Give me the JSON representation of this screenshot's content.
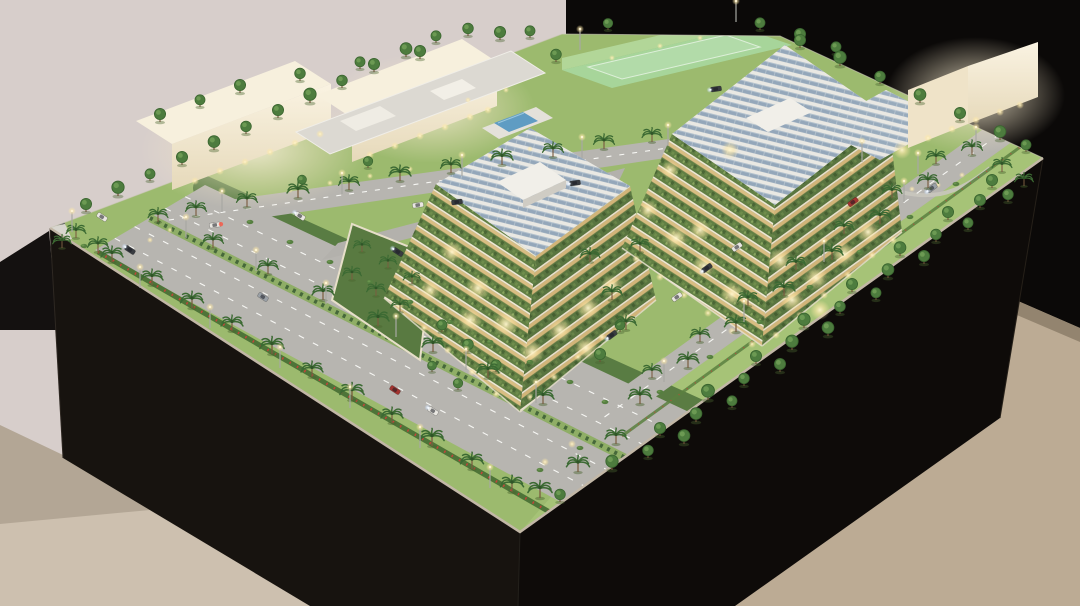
{
  "colors": {
    "wall": "#d7cecb",
    "backdrop": "#0b0908",
    "floor_left": "#cdc0af",
    "floor_right": "#bcab94",
    "skirting": "#93846f",
    "shadow_wedge": "#141110",
    "plinth_left": "#17130f",
    "plinth_right": "#0e0b09",
    "grass": "#9cba6e",
    "lawn": "#a6c377",
    "garden": "#54763f",
    "road": "#b7b5b0",
    "road_line": "#f7f7f4",
    "median": "#8fae66",
    "hedge": "#4e7438",
    "hedge_flowers": "#c2453a",
    "fascia": "#c2b7a6",
    "back_wall_line": "#cdc8ba",
    "white_roof": "#f7f0dd",
    "white_face_top": "#faf3e2",
    "white_face_bottom": "#e6d9ba",
    "white_side": "#efe3c8",
    "canopy": "#dcd9d2",
    "pool": "#5f9cc3",
    "pool_deck": "#e4e1da",
    "court": "#a8d8a0",
    "court_fence": "#c4ecbc",
    "terrace_green_l": "#617f44",
    "terrace_green_r": "#597540",
    "terrace_glow_l": "#d9bd82",
    "terrace_glow_r": "#d2b478",
    "terrace_line": "#efe8d6",
    "roof_white": "#e9e8e3",
    "solar": "#8fa4b8",
    "garden_court": "#597a41",
    "garden_wall": "#e7dfc9",
    "path": "#c9c6be",
    "pole": "#a8a8a3",
    "plaque_dark": "#55555a",
    "plaque_light": "#d8d6cf",
    "palm_leaf": "#3c6a33",
    "palm_trunk": "#7a5c40",
    "tree_green": "#4d7c3e",
    "tree_dark": "#3a652f",
    "tree_light": "#74a159",
    "bush": "#567f40",
    "warm_light": "#fff3c0",
    "cool_light": "#e8f2ff"
  },
  "car_colors": [
    "#a33430",
    "#e9e7e1",
    "#383b40",
    "#9aa0a6"
  ],
  "scene": {
    "palms": [
      [
        112,
        262,
        1
      ],
      [
        152,
        285,
        1
      ],
      [
        192,
        308,
        1.05
      ],
      [
        232,
        331,
        1
      ],
      [
        272,
        354,
        1.1
      ],
      [
        312,
        377,
        1
      ],
      [
        352,
        400,
        1.1
      ],
      [
        392,
        423,
        1
      ],
      [
        432,
        446,
        1.1
      ],
      [
        472,
        469,
        1.05
      ],
      [
        512,
        492,
        1.05
      ],
      [
        158,
        222,
        0.9
      ],
      [
        213,
        248,
        0.95
      ],
      [
        268,
        274,
        0.95
      ],
      [
        323,
        300,
        1
      ],
      [
        378,
        326,
        1
      ],
      [
        433,
        352,
        1
      ],
      [
        488,
        378,
        1
      ],
      [
        543,
        404,
        1
      ],
      [
        196,
        216,
        0.95
      ],
      [
        247,
        207,
        0.95
      ],
      [
        298,
        198,
        1
      ],
      [
        349,
        190,
        0.95
      ],
      [
        400,
        181,
        1
      ],
      [
        451,
        173,
        0.95
      ],
      [
        502,
        165,
        1
      ],
      [
        553,
        157,
        0.95
      ],
      [
        604,
        149,
        0.95
      ],
      [
        652,
        142,
        0.9
      ],
      [
        640,
        404,
        1.05
      ],
      [
        688,
        368,
        1
      ],
      [
        736,
        332,
        1.05
      ],
      [
        784,
        296,
        1
      ],
      [
        832,
        260,
        1
      ],
      [
        880,
        224,
        1
      ],
      [
        928,
        188,
        0.95
      ],
      [
        972,
        155,
        0.95
      ],
      [
        652,
        378,
        0.9
      ],
      [
        700,
        342,
        0.9
      ],
      [
        748,
        306,
        0.95
      ],
      [
        796,
        270,
        0.9
      ],
      [
        844,
        234,
        0.9
      ],
      [
        892,
        198,
        0.9
      ],
      [
        936,
        164,
        0.9
      ],
      [
        76,
        238,
        0.9
      ],
      [
        98,
        252,
        0.95
      ],
      [
        62,
        248,
        0.85
      ],
      [
        540,
        498,
        1.1
      ],
      [
        578,
        472,
        1.05
      ],
      [
        616,
        444,
        1
      ],
      [
        1002,
        172,
        0.9
      ],
      [
        1024,
        186,
        0.85
      ],
      [
        612,
        300,
        0.95
      ],
      [
        626,
        330,
        0.95
      ],
      [
        590,
        262,
        0.9
      ],
      [
        640,
        252,
        0.9
      ],
      [
        352,
        280,
        0.85
      ],
      [
        376,
        296,
        0.85
      ],
      [
        400,
        312,
        0.85
      ],
      [
        362,
        252,
        0.8
      ],
      [
        388,
        268,
        0.8
      ],
      [
        412,
        284,
        0.8
      ]
    ],
    "round_trees": [
      [
        86,
        212,
        1
      ],
      [
        118,
        196,
        1.1
      ],
      [
        150,
        181,
        0.9
      ],
      [
        182,
        165,
        1
      ],
      [
        214,
        150,
        1.05
      ],
      [
        246,
        134,
        0.95
      ],
      [
        278,
        118,
        1
      ],
      [
        310,
        103,
        1.1
      ],
      [
        342,
        88,
        0.95
      ],
      [
        374,
        72,
        1
      ],
      [
        406,
        57,
        1.05
      ],
      [
        436,
        43,
        0.9
      ],
      [
        468,
        36,
        0.95
      ],
      [
        500,
        40,
        1
      ],
      [
        530,
        38,
        0.9
      ],
      [
        608,
        30,
        0.85
      ],
      [
        760,
        30,
        0.9
      ],
      [
        800,
        48,
        1
      ],
      [
        840,
        66,
        1.1
      ],
      [
        880,
        84,
        0.95
      ],
      [
        920,
        103,
        1.05
      ],
      [
        960,
        121,
        1
      ],
      [
        1000,
        140,
        1.05
      ],
      [
        1026,
        152,
        0.9
      ],
      [
        612,
        470,
        1.1
      ],
      [
        660,
        436,
        1
      ],
      [
        708,
        400,
        1.15
      ],
      [
        756,
        364,
        1
      ],
      [
        804,
        328,
        1.1
      ],
      [
        852,
        292,
        1
      ],
      [
        900,
        256,
        1.05
      ],
      [
        948,
        220,
        1
      ],
      [
        992,
        188,
        1
      ],
      [
        648,
        458,
        0.95
      ],
      [
        696,
        422,
        1.05
      ],
      [
        744,
        386,
        0.95
      ],
      [
        792,
        350,
        1.1
      ],
      [
        840,
        314,
        0.95
      ],
      [
        888,
        278,
        1.05
      ],
      [
        936,
        242,
        0.95
      ],
      [
        980,
        208,
        1
      ],
      [
        684,
        444,
        1.05
      ],
      [
        732,
        408,
        0.9
      ],
      [
        780,
        372,
        1
      ],
      [
        828,
        336,
        1.05
      ],
      [
        876,
        300,
        0.9
      ],
      [
        924,
        264,
        1
      ],
      [
        968,
        230,
        0.9
      ],
      [
        1008,
        202,
        0.95
      ],
      [
        160,
        122,
        1
      ],
      [
        200,
        107,
        0.9
      ],
      [
        240,
        93,
        1
      ],
      [
        300,
        81,
        0.95
      ],
      [
        360,
        69,
        0.9
      ],
      [
        420,
        59,
        1
      ],
      [
        442,
        332,
        0.9
      ],
      [
        468,
        352,
        0.95
      ],
      [
        496,
        372,
        0.9
      ],
      [
        458,
        390,
        0.85
      ],
      [
        432,
        372,
        0.8
      ],
      [
        368,
        168,
        0.85
      ],
      [
        302,
        186,
        0.8
      ],
      [
        556,
        62,
        0.95
      ],
      [
        800,
        42,
        1
      ],
      [
        836,
        54,
        0.9
      ],
      [
        620,
        332,
        0.9
      ],
      [
        600,
        362,
        1
      ],
      [
        560,
        502,
        0.95
      ]
    ],
    "bushes": [
      [
        250,
        222
      ],
      [
        290,
        242
      ],
      [
        330,
        262
      ],
      [
        370,
        282
      ],
      [
        410,
        302
      ],
      [
        450,
        322
      ],
      [
        490,
        342
      ],
      [
        530,
        362
      ],
      [
        570,
        382
      ],
      [
        605,
        402
      ],
      [
        660,
        392
      ],
      [
        710,
        357
      ],
      [
        760,
        322
      ],
      [
        810,
        287
      ],
      [
        860,
        252
      ],
      [
        910,
        217
      ],
      [
        956,
        184
      ],
      [
        84,
        246
      ],
      [
        540,
        470
      ],
      [
        580,
        448
      ]
    ],
    "cars": [
      [
        130,
        250,
        33,
        2,
        1
      ],
      [
        102,
        217,
        33,
        1,
        0
      ],
      [
        263,
        297,
        33,
        3,
        0
      ],
      [
        398,
        252,
        33,
        2,
        1
      ],
      [
        395,
        390,
        33,
        0,
        0
      ],
      [
        433,
        411,
        33,
        1,
        1
      ],
      [
        300,
        216,
        33,
        1,
        1
      ],
      [
        215,
        225,
        -8,
        1,
        2
      ],
      [
        457,
        202,
        -8,
        2,
        0
      ],
      [
        418,
        205,
        -8,
        1,
        0
      ],
      [
        575,
        183,
        -8,
        2,
        1
      ],
      [
        716,
        89,
        -8,
        2,
        1
      ],
      [
        707,
        268,
        -36,
        2,
        1
      ],
      [
        737,
        247,
        -36,
        1,
        0
      ],
      [
        853,
        202,
        -36,
        0,
        0
      ],
      [
        932,
        188,
        -36,
        3,
        1
      ],
      [
        612,
        335,
        -36,
        2,
        1
      ],
      [
        677,
        297,
        -36,
        1,
        0
      ]
    ],
    "poles": [
      [
        140,
        288
      ],
      [
        210,
        328
      ],
      [
        280,
        368
      ],
      [
        350,
        408
      ],
      [
        420,
        448
      ],
      [
        490,
        488
      ],
      [
        186,
        238
      ],
      [
        256,
        271
      ],
      [
        326,
        304
      ],
      [
        396,
        337
      ],
      [
        466,
        370
      ],
      [
        536,
        403
      ],
      [
        222,
        212
      ],
      [
        342,
        194
      ],
      [
        462,
        176
      ],
      [
        582,
        158
      ],
      [
        668,
        146
      ],
      [
        664,
        382
      ],
      [
        744,
        322
      ],
      [
        824,
        262
      ],
      [
        904,
        202
      ],
      [
        976,
        148
      ],
      [
        580,
        50
      ],
      [
        736,
        22
      ],
      [
        862,
        162
      ],
      [
        918,
        174
      ],
      [
        72,
        232
      ]
    ],
    "glows": [
      [
        195,
        181,
        4
      ],
      [
        220,
        171,
        4
      ],
      [
        245,
        162,
        4
      ],
      [
        270,
        152,
        4
      ],
      [
        295,
        143,
        4
      ],
      [
        320,
        134,
        4
      ],
      [
        370,
        155,
        4
      ],
      [
        395,
        146,
        4
      ],
      [
        420,
        136,
        4
      ],
      [
        445,
        127,
        4
      ],
      [
        470,
        117,
        4
      ],
      [
        488,
        110,
        4
      ],
      [
        928,
        138,
        4
      ],
      [
        952,
        129,
        4
      ],
      [
        976,
        120,
        4
      ],
      [
        1000,
        112,
        4
      ],
      [
        1020,
        105,
        4
      ],
      [
        400,
        306,
        4
      ],
      [
        424,
        328,
        4
      ],
      [
        448,
        350,
        4
      ],
      [
        472,
        372,
        4
      ],
      [
        496,
        394,
        4
      ],
      [
        530,
        397,
        4
      ],
      [
        554,
        377,
        4
      ],
      [
        578,
        357,
        4
      ],
      [
        602,
        337,
        4
      ],
      [
        626,
        317,
        4
      ],
      [
        636,
        259,
        4
      ],
      [
        660,
        277,
        4
      ],
      [
        684,
        295,
        4
      ],
      [
        708,
        313,
        4
      ],
      [
        732,
        331,
        4
      ],
      [
        752,
        344,
        4
      ],
      [
        776,
        335,
        4
      ],
      [
        800,
        315,
        4
      ],
      [
        824,
        295,
        4
      ],
      [
        848,
        275,
        4
      ],
      [
        872,
        255,
        4
      ],
      [
        893,
        240,
        4
      ],
      [
        250,
        197,
        3
      ],
      [
        290,
        190,
        3
      ],
      [
        330,
        183,
        3
      ],
      [
        370,
        176,
        3
      ],
      [
        410,
        169,
        3
      ],
      [
        450,
        162,
        3
      ],
      [
        490,
        156,
        3
      ],
      [
        530,
        149,
        3
      ],
      [
        612,
        58,
        3
      ],
      [
        660,
        46,
        3
      ],
      [
        700,
        38,
        3
      ],
      [
        852,
        170,
        3
      ],
      [
        882,
        181,
        3
      ],
      [
        912,
        189,
        3
      ],
      [
        938,
        185,
        3
      ],
      [
        962,
        175,
        3
      ],
      [
        468,
        100,
        3
      ],
      [
        506,
        90,
        3
      ],
      [
        545,
        462,
        4
      ],
      [
        572,
        444,
        4
      ],
      [
        150,
        240,
        3
      ],
      [
        170,
        230,
        3
      ],
      [
        452,
        252,
        11
      ],
      [
        478,
        288,
        12
      ],
      [
        506,
        324,
        13
      ],
      [
        532,
        352,
        12
      ],
      [
        470,
        320,
        12
      ],
      [
        430,
        290,
        10
      ],
      [
        560,
        330,
        12
      ],
      [
        588,
        308,
        12
      ],
      [
        612,
        286,
        11
      ],
      [
        586,
        348,
        12
      ],
      [
        648,
        210,
        10
      ],
      [
        676,
        238,
        12
      ],
      [
        704,
        266,
        12
      ],
      [
        732,
        294,
        12
      ],
      [
        700,
        230,
        11
      ],
      [
        792,
        300,
        12
      ],
      [
        816,
        278,
        12
      ],
      [
        844,
        254,
        12
      ],
      [
        868,
        232,
        11
      ],
      [
        820,
        310,
        10
      ],
      [
        780,
        260,
        12
      ],
      [
        902,
        150,
        9
      ],
      [
        730,
        150,
        9
      ],
      [
        670,
        170,
        9
      ]
    ]
  }
}
